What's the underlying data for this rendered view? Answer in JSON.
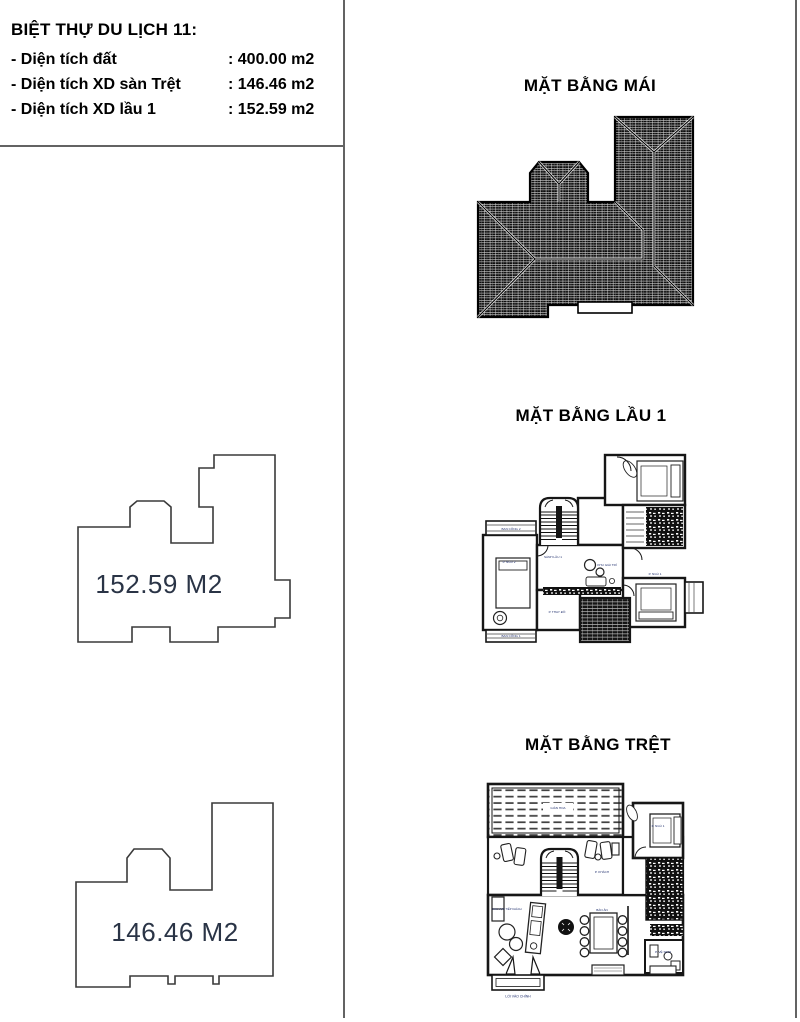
{
  "document": {
    "info_box": {
      "title": "BIỆT THỰ DU LỊCH 11:",
      "rows": [
        {
          "label": "- Diện tích đất",
          "value": ": 400.00 m2"
        },
        {
          "label": "- Diện tích XD sàn Trệt",
          "value": ": 146.46 m2"
        },
        {
          "label": "- Diện tích XD lầu 1",
          "value": ": 152.59 m2"
        }
      ]
    },
    "area_shapes": {
      "floor1": {
        "label": "152.59 M2"
      },
      "ground": {
        "label": "146.46 M2"
      }
    },
    "plans": {
      "roof": {
        "title": "MẶT BẰNG MÁI"
      },
      "floor1": {
        "title": "MẶT BẰNG LẦU 1"
      },
      "ground": {
        "title": "MẶT BẰNG TRỆT"
      }
    },
    "tiny_room_labels": {
      "floor1": {
        "balcony2": "BAN CÔNG 2",
        "bed_left": "P. NGỦ 2",
        "hall": "SẢNH LẦU 1",
        "entertainment": "KHU GIẢI TRÍ",
        "bed_right": "P. NGỦ 1",
        "balcony1": "BAN CÔNG 1",
        "dressing": "P. THAY ĐỒ"
      },
      "ground": {
        "pergola": "GIÀN HOA",
        "living": "P. KHÁCH",
        "reception": "KHU VỰC TIẾP KHÁCH",
        "dining": "BÀN ĂN",
        "bedroom": "P. NGỦ 1",
        "wc": "P. VỆ SINH",
        "entrance": "LỐI VÀO CHÍNH"
      }
    },
    "colors": {
      "divider": "#636363",
      "walls": "#161616",
      "room_label_blue": "#21306e",
      "area_text": "#2a3446"
    }
  }
}
